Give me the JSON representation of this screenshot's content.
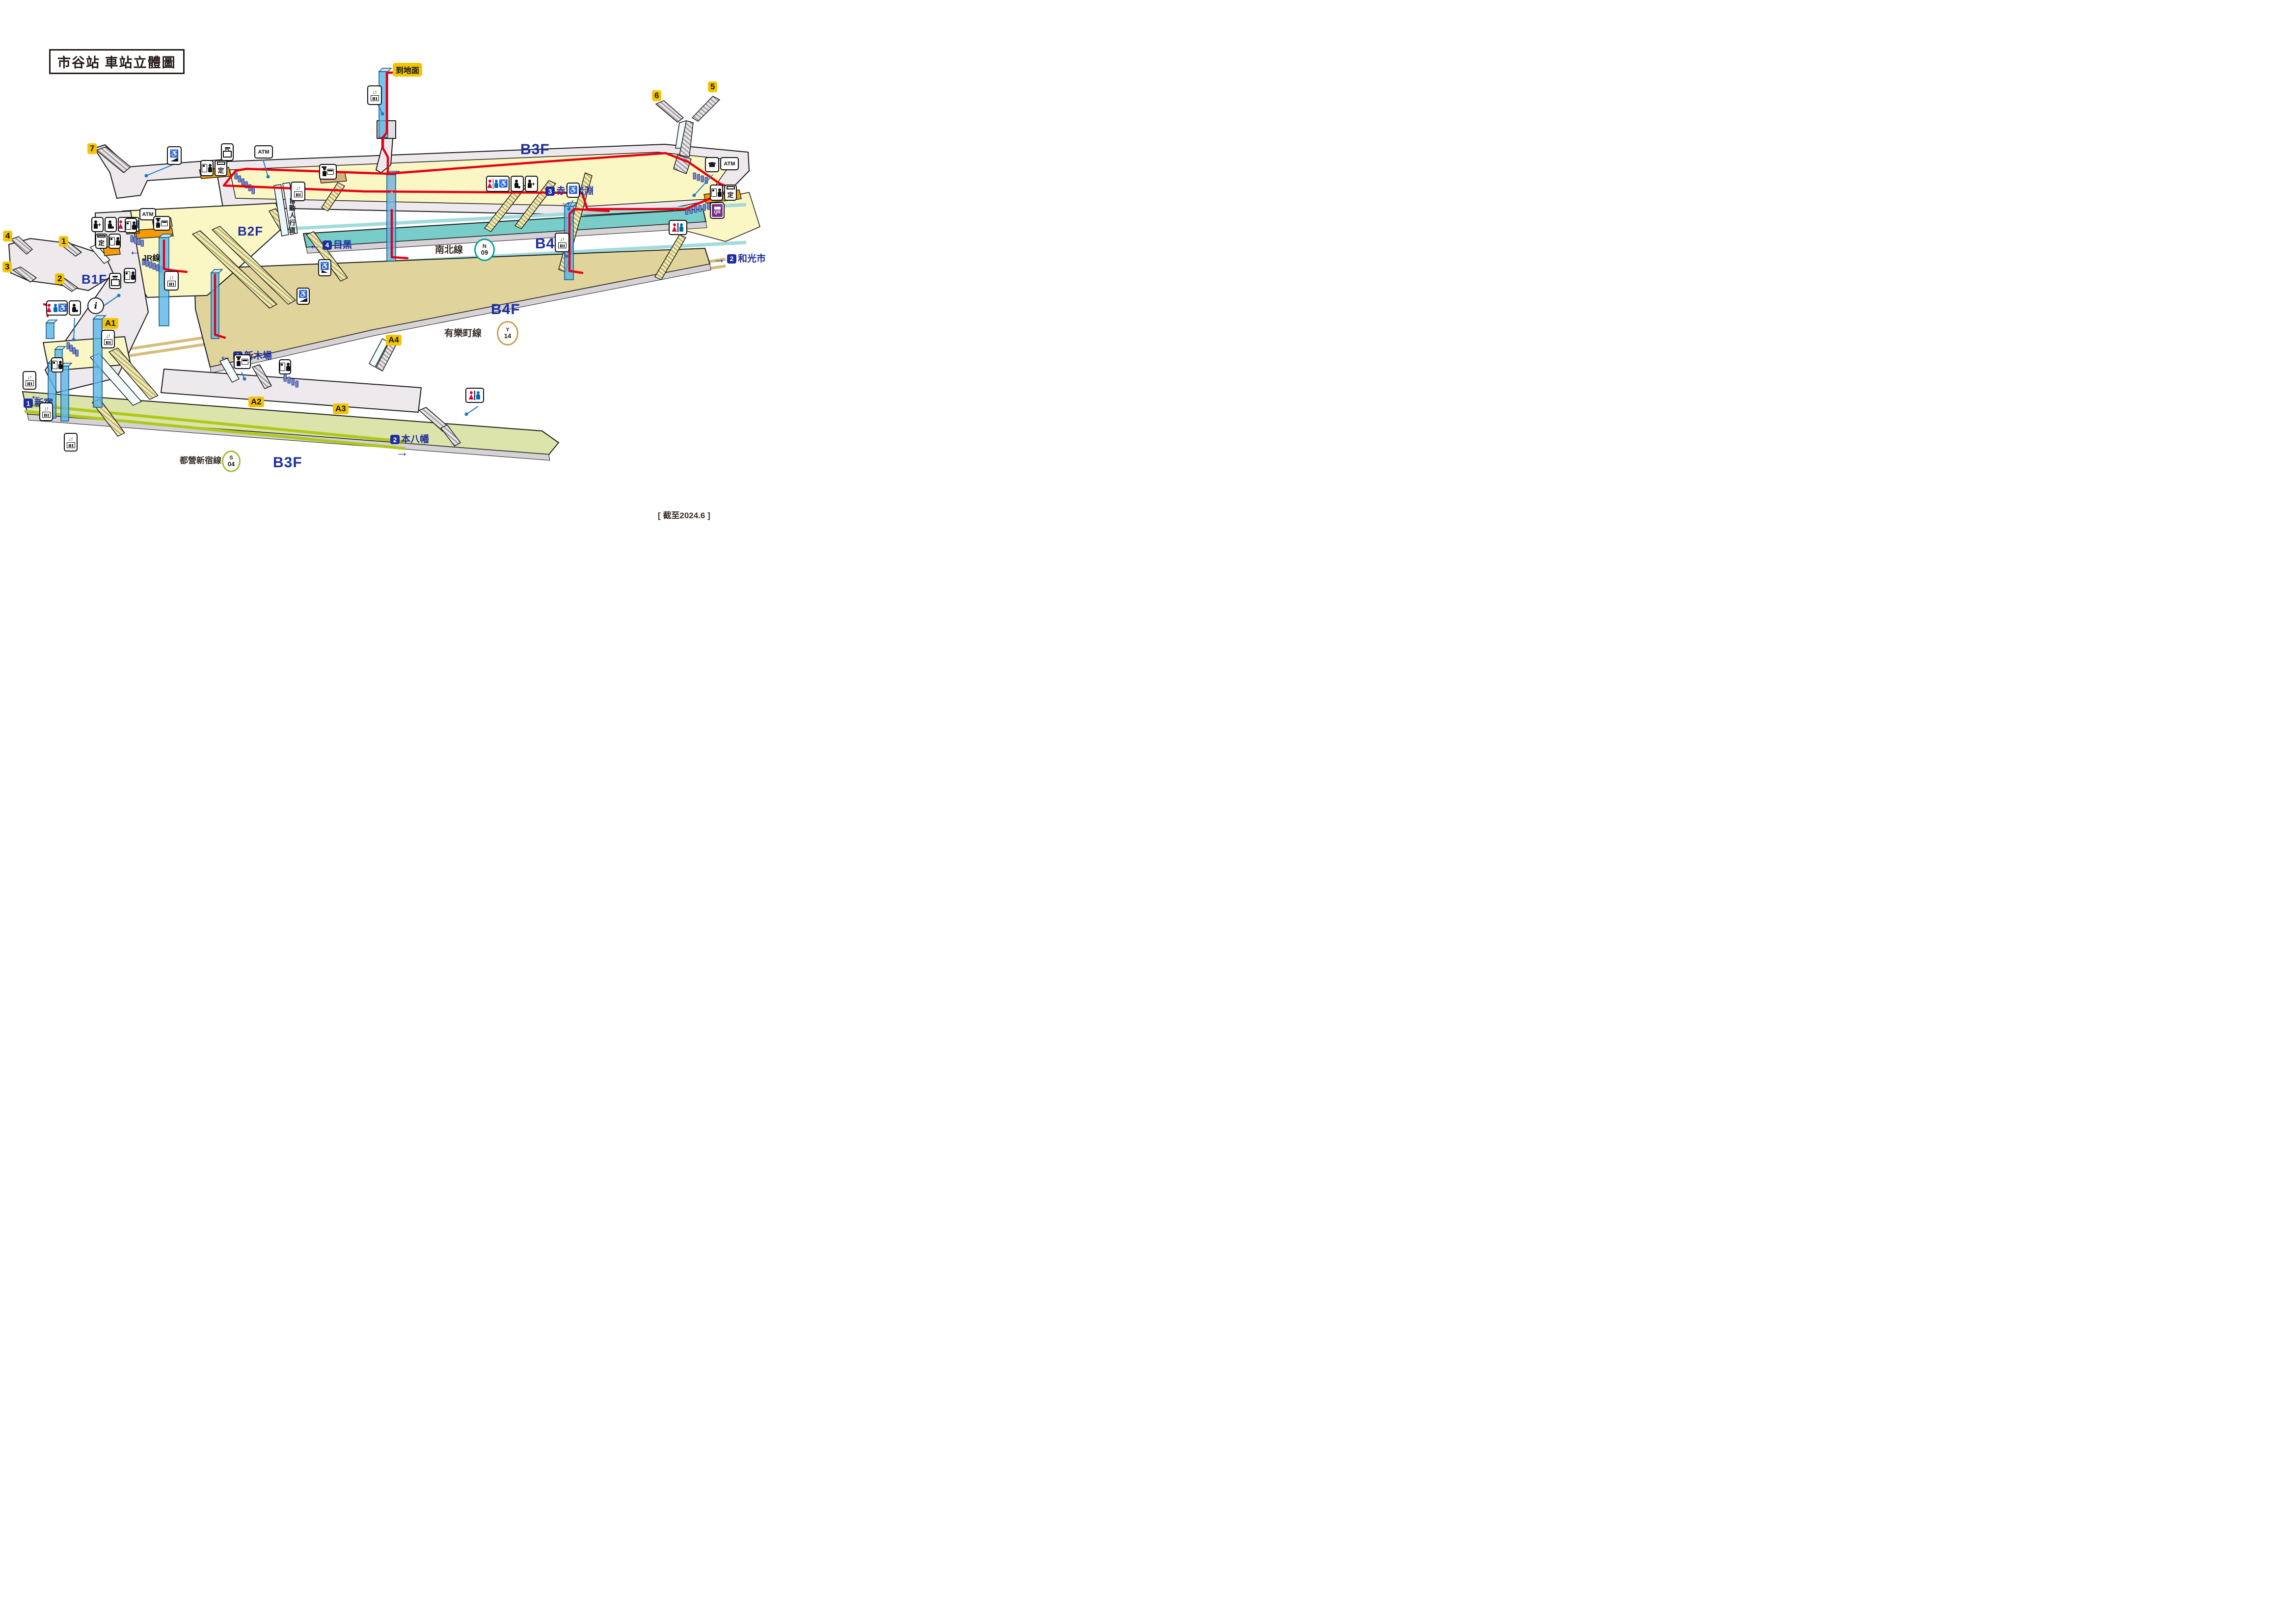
{
  "title": "市谷站 車站立體圖",
  "as_of": "[ 截至2024.6 ]",
  "floors": {
    "b3f_top": "B3F",
    "b2f": "B2F",
    "b1f": "B1F",
    "b4f_namboku": "B4F",
    "b4f_yurakucho": "B4F",
    "b3f_toei": "B3F"
  },
  "lines": {
    "namboku": {
      "name": "南北線",
      "code_letter": "N",
      "code_number": "09",
      "color": "#00A29A"
    },
    "yurakucho": {
      "name": "有樂町線",
      "code_letter": "Y",
      "code_number": "14",
      "color": "#C8A050"
    },
    "toei_shinjuku": {
      "name": "都營新宿線",
      "code_letter": "S",
      "code_number": "04",
      "color": "#9FBE2E"
    }
  },
  "directions": {
    "to_ground": {
      "label": "到地面"
    },
    "meguro": {
      "num": "4",
      "label": "目黑",
      "arrow": "←"
    },
    "akabane_iwabuchi": {
      "num": "3",
      "label": "赤羽岩淵",
      "arrow": "→"
    },
    "wakoshi": {
      "num": "2",
      "label": "和光市",
      "arrow": "→"
    },
    "shin_kiba": {
      "num": "1",
      "label": "新木場",
      "arrow": "←"
    },
    "shinjuku": {
      "num": "1",
      "label": "新宿",
      "arrow": "←"
    },
    "motoyawata": {
      "num": "2",
      "label": "本八幡",
      "arrow": "→"
    }
  },
  "exits": {
    "e1": "1",
    "e2": "2",
    "e3": "3",
    "e4": "4",
    "e5": "5",
    "e6": "6",
    "e7": "7",
    "a1": "A1",
    "a2": "A2",
    "a3": "A3",
    "a4": "A4"
  },
  "labels": {
    "jr_line": "JR線",
    "moving_walkway": "自動人行道"
  },
  "icons": {
    "atm": "ATM",
    "teiki": "定",
    "qr": "QR",
    "info": "i",
    "phone": "☎",
    "wheelchair": "♿",
    "elevator_arrows": "↓↑",
    "plus": "+"
  },
  "colors": {
    "route_red": "#E60012",
    "elevator_blue": "#58B5E9",
    "floor_yellow": "#FBF7C5",
    "concourse_gray": "#EDE9ED",
    "platform_teal": "#79CDC9",
    "platform_tan": "#E0D49C",
    "platform_green": "#DCE4AC",
    "machine_orange": "#F59B00",
    "gate_blue": "#7587C8",
    "exit_badge_yellow": "#F5C400",
    "label_navy": "#1D2E9C"
  }
}
